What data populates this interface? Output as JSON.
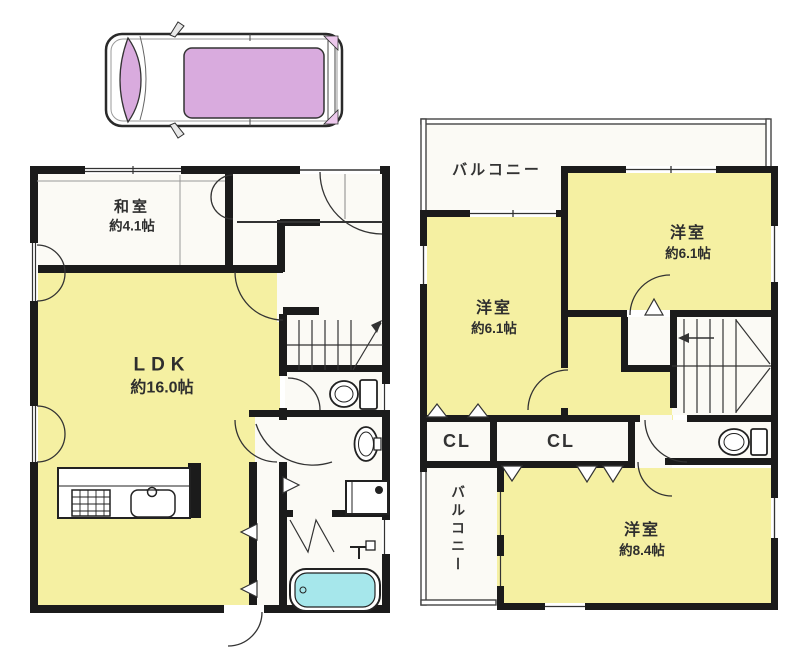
{
  "document": {
    "type": "floor-plan",
    "floors": 2
  },
  "colors": {
    "room_yellow": "#f5f0a2",
    "room_white": "#fbfaf5",
    "wall_black": "#1b1b1b",
    "bathtub_cyan": "#a6e7eb",
    "car_glass_purple": "#d9abde",
    "background": "#ffffff"
  },
  "floor1": {
    "washitsu": {
      "name": "和室",
      "size": "約4.1帖"
    },
    "ldk": {
      "name": "LDK",
      "size": "約16.0帖"
    }
  },
  "floor2": {
    "balcony_top": "バルコニー",
    "bedroom_right": {
      "name": "洋室",
      "size": "約6.1帖"
    },
    "bedroom_left": {
      "name": "洋室",
      "size": "約6.1帖"
    },
    "closet_left": "CL",
    "closet_center": "CL",
    "balcony_side": "バルコニー",
    "bedroom_main": {
      "name": "洋室",
      "size": "約8.4帖"
    }
  },
  "icons": {
    "car": "car-top-view-icon",
    "stove": "stove-icon",
    "sink": "sink-icon",
    "toilet": "toilet-icon",
    "washbasin": "washbasin-icon",
    "washing_machine": "washing-machine-icon",
    "bathtub": "bathtub-icon",
    "stairs": "stairs-icon",
    "door": "door-arc-icon"
  }
}
